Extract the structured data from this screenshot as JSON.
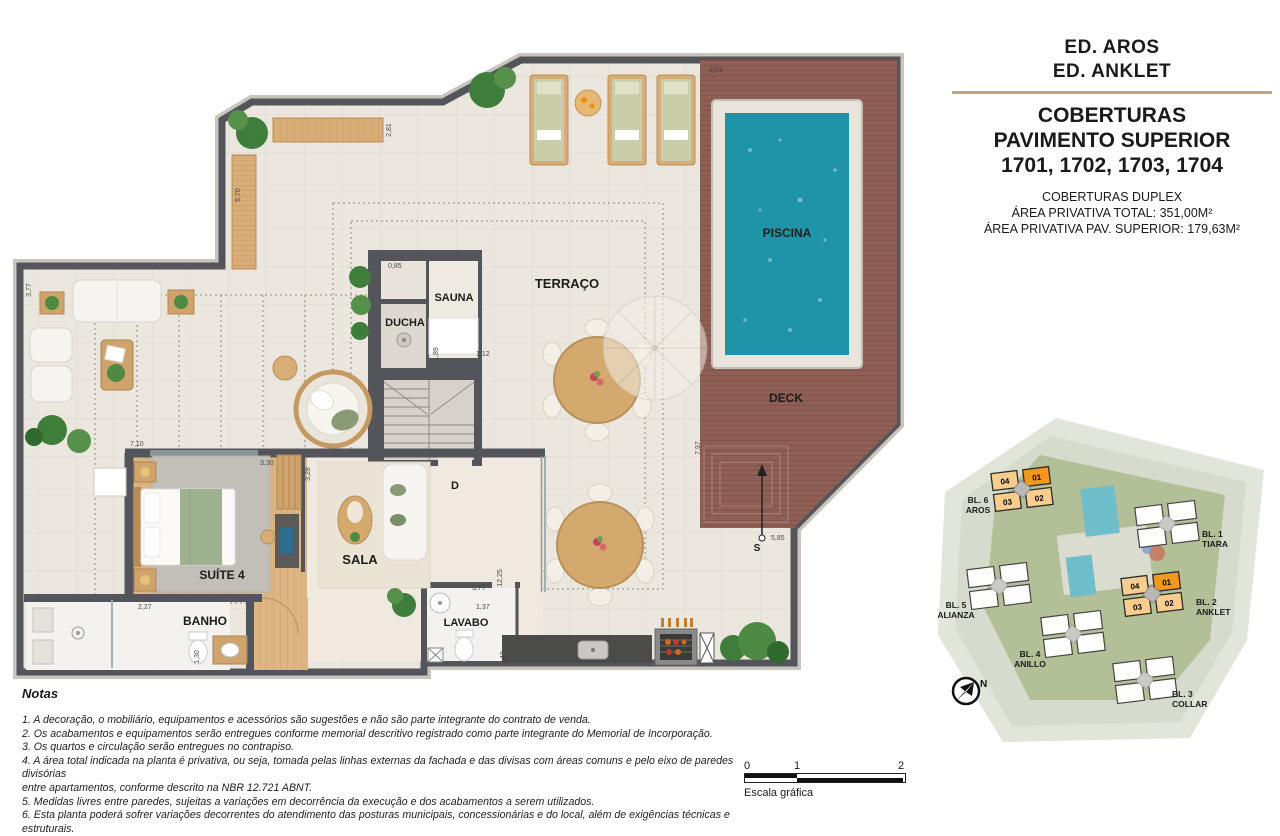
{
  "title_block": {
    "building_1": "ED. AROS",
    "building_2": "ED. ANKLET",
    "heading_line_1": "COBERTURAS",
    "heading_line_2": "PAVIMENTO SUPERIOR",
    "heading_line_3": "1701, 1702, 1703, 1704",
    "subtitle_1": "COBERTURAS DUPLEX",
    "subtitle_2": "ÁREA PRIVATIVA TOTAL: 351,00M²",
    "subtitle_3": "ÁREA PRIVATIVA PAV. SUPERIOR: 179,63M²",
    "accent_color": "#c9a27c"
  },
  "floorplan": {
    "rooms": {
      "piscina": "PISCINA",
      "terraco": "TERRAÇO",
      "deck": "DECK",
      "sauna": "SAUNA",
      "ducha": "DUCHA",
      "sala": "SALA",
      "suite4": "SUÍTE 4",
      "banho": "BANHO",
      "lavabo": "LAVABO",
      "stair_door": "D",
      "south_marker": "S"
    },
    "dimensions": {
      "d970": "9,70",
      "d281": "2,81",
      "d363": "3,63",
      "d377_left": "3,77",
      "d710": "7,10",
      "d085": "0,85",
      "d189": "1,89",
      "d112": "1,12",
      "d330": "3,30",
      "d328": "3,28",
      "d227": "2,27",
      "d130": "1,30",
      "d377_bottom": "3,77",
      "d137": "1,37",
      "d143": "1,43",
      "d1225": "12,25",
      "d797": "7,97",
      "d585": "5,85"
    },
    "colors": {
      "pool": "#1f93a8",
      "deck": "#8f5e55",
      "wall": "#54555a",
      "floor": "#ece7de",
      "wood": "#dcb582"
    }
  },
  "site_plan": {
    "units": [
      "04",
      "01",
      "03",
      "02"
    ],
    "blocks": {
      "bl6": {
        "line1": "BL. 6",
        "line2": "AROS"
      },
      "bl1": {
        "line1": "BL. 1",
        "line2": "TIARA"
      },
      "bl5": {
        "line1": "BL. 5",
        "line2": "ALIANZA"
      },
      "bl2": {
        "line1": "BL. 2",
        "line2": "ANKLET"
      },
      "bl4": {
        "line1": "BL. 4",
        "line2": "ANILLO"
      },
      "bl3": {
        "line1": "BL. 3",
        "line2": "COLLAR"
      }
    },
    "north_label": "N",
    "highlight_color": "#f8cd8e",
    "unit01_color": "#f2991d"
  },
  "notes": {
    "heading": "Notas",
    "items": [
      "1. A decoração, o mobiliário, equipamentos e acessórios são sugestões e não são parte integrante do contrato de venda.",
      "2. Os acabamentos e equipamentos serão entregues conforme memorial descritivo registrado como parte integrante do Memorial de Incorporação.",
      "3. Os quartos e circulação serão entregues no contrapiso.",
      "4. A área total indicada na planta é privativa, ou seja, tomada pelas linhas externas da fachada e das divisas com áreas comuns e pelo eixo de paredes divisórias\nentre apartamentos, conforme descrito na NBR 12.721 ABNT.",
      "5. Medidas livres entre paredes, sujeitas a variações em decorrência da execução e dos acabamentos a serem utilizados.",
      "6. Esta planta poderá sofrer variações decorrentes do atendimento das posturas municipais, concessionárias e do local, além de exigências técnicas e estruturais."
    ]
  },
  "scale_bar": {
    "tick0": "0",
    "tick1": "1",
    "tick2": "2",
    "label": "Escala gráfica"
  }
}
